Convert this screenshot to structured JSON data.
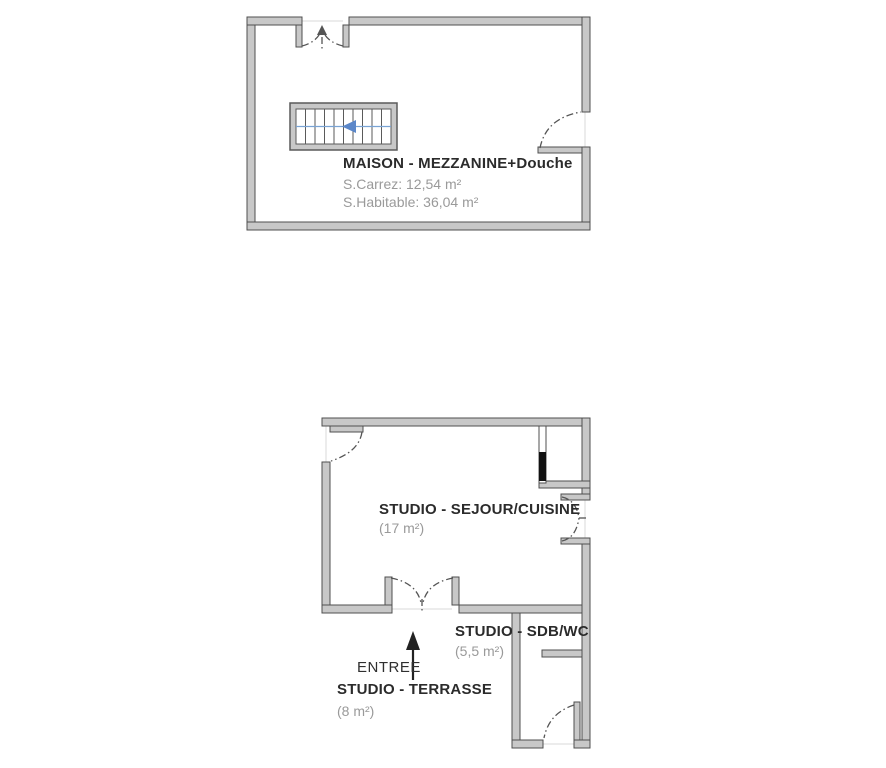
{
  "plan_top": {
    "title": "MAISON - MEZZANINE+Douche",
    "carrez_label": "S.Carrez: 12,54 m²",
    "habitable_label": "S.Habitable: 36,04 m²"
  },
  "plan_bottom": {
    "sejour": {
      "title": "STUDIO - SEJOUR/CUISINE",
      "area": "(17 m²)"
    },
    "sdb": {
      "title": "STUDIO - SDB/WC",
      "area": "(5,5 m²)"
    },
    "entree_label": "ENTREE",
    "terrasse": {
      "title": "STUDIO - TERRASSE",
      "area": "(8 m²)"
    }
  },
  "colors": {
    "wall_fill": "#c8c8c8",
    "wall_stroke": "#4f4f4f",
    "door_arc": "#555555",
    "threshold": "#e0e0e0",
    "stair_arrow_blue": "#5b87c9",
    "placard_door_black": "#111111",
    "title_text": "#2b2b2b",
    "area_text": "#9a9a9a"
  }
}
